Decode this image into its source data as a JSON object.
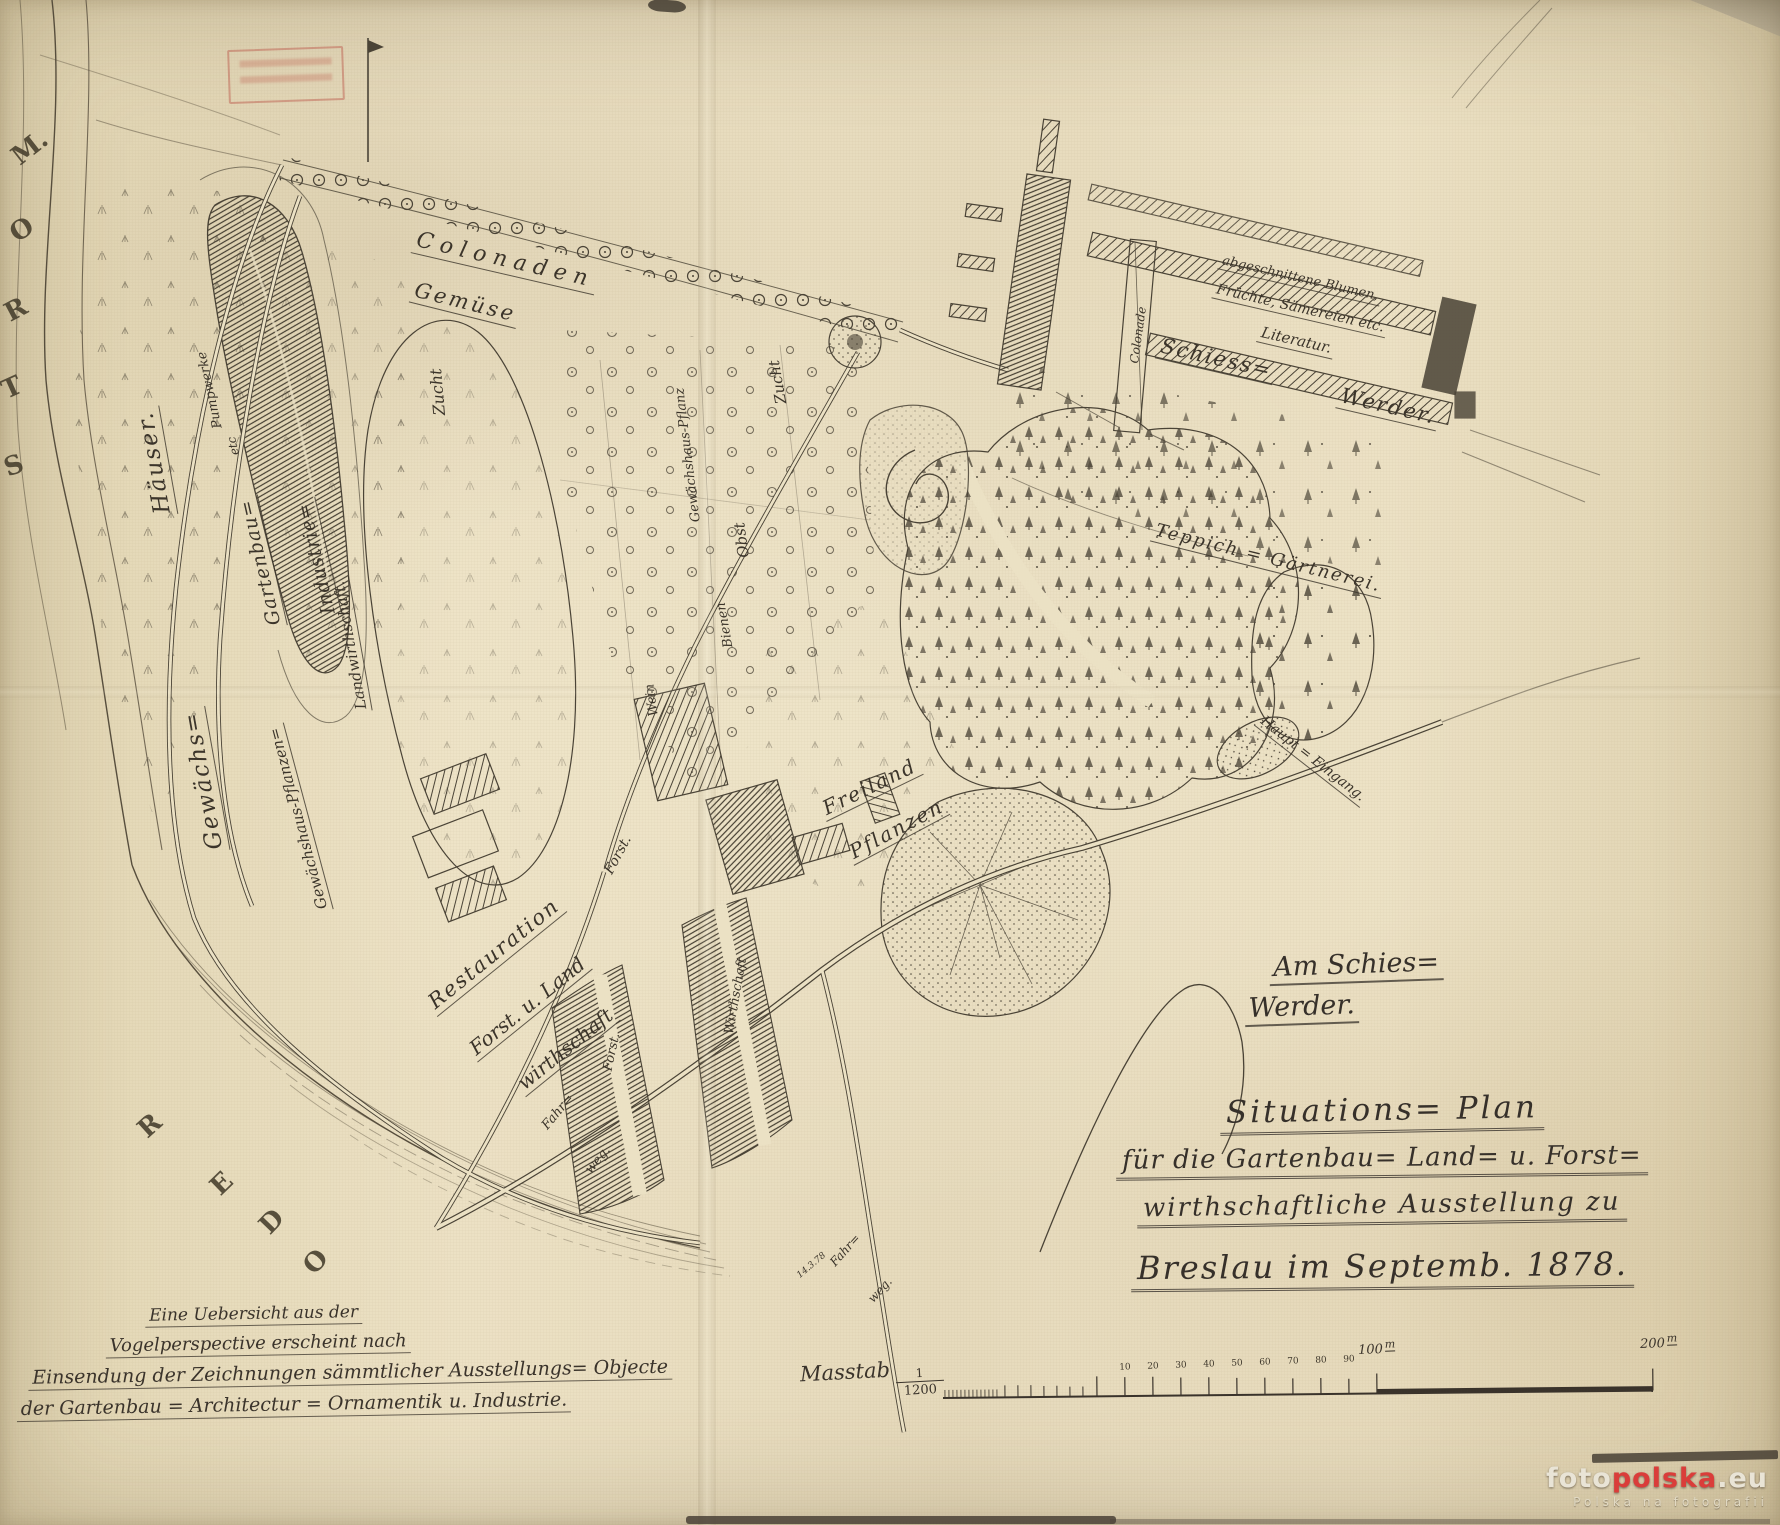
{
  "colors": {
    "ink": "#4a4336",
    "label_ink": "#3b342a",
    "paper": "#ebe1c4",
    "stamp_red": "#bb5446",
    "watermark_red": "#da3d3a"
  },
  "title_block": {
    "line1": "Situations= Plan",
    "line2": "für die Gartenbau= Land= u. Forst=",
    "line3": "wirthschaftliche Ausstellung zu",
    "line4": "Breslau im Septemb. 1878."
  },
  "area_note": {
    "line1": "Am Schies=",
    "line2": "Werder."
  },
  "note_block": {
    "line1": "Eine Uebersicht aus der",
    "line2": "Vogelperspective erscheint nach",
    "line3": "Einsendung der Zeichnungen sämmtlicher Ausstellungs= Objecte",
    "line4": "der Gartenbau = Architectur = Ornamentik u. Industrie."
  },
  "scale_bar": {
    "label": "Masstab",
    "fraction_numerator": "1",
    "fraction_denominator": "1200",
    "label_100": "100",
    "label_200": "200",
    "unit": "m"
  },
  "watermark": {
    "foto": "foto",
    "polska": "polska",
    "eu": ".eu",
    "tagline": "Polska na fotografii"
  },
  "map_labels": [
    {
      "t": "M.",
      "x": 30,
      "y": 148,
      "r": -38,
      "s": 26,
      "c": "riv"
    },
    {
      "t": "O",
      "x": 22,
      "y": 230,
      "r": -32,
      "s": 26,
      "c": "riv"
    },
    {
      "t": "R",
      "x": 16,
      "y": 310,
      "r": -28,
      "s": 26,
      "c": "riv"
    },
    {
      "t": "T",
      "x": 12,
      "y": 388,
      "r": -24,
      "s": 26,
      "c": "riv"
    },
    {
      "t": "S",
      "x": 14,
      "y": 466,
      "r": -20,
      "s": 26,
      "c": "riv"
    },
    {
      "t": "R",
      "x": 150,
      "y": 1126,
      "r": -42,
      "s": 26,
      "c": "riv"
    },
    {
      "t": "E",
      "x": 222,
      "y": 1184,
      "r": -44,
      "s": 26,
      "c": "riv"
    },
    {
      "t": "D",
      "x": 272,
      "y": 1222,
      "r": -46,
      "s": 26,
      "c": "riv"
    },
    {
      "t": "O",
      "x": 316,
      "y": 1262,
      "r": -48,
      "s": 26,
      "c": "riv"
    },
    {
      "t": "Gewächs=",
      "x": 205,
      "y": 780,
      "r": -100,
      "s": 23,
      "c": "u",
      "ls": 2
    },
    {
      "t": "Häuser.",
      "x": 156,
      "y": 462,
      "r": -100,
      "s": 23,
      "c": "u",
      "ls": 2
    },
    {
      "t": "Pumpwerke",
      "x": 210,
      "y": 390,
      "r": -102,
      "s": 13
    },
    {
      "t": "etc",
      "x": 233,
      "y": 446,
      "r": -102,
      "s": 12
    },
    {
      "t": "Gartenbau=",
      "x": 262,
      "y": 562,
      "r": -103,
      "s": 19,
      "c": "u",
      "ls": 1
    },
    {
      "t": "Industrie=",
      "x": 318,
      "y": 558,
      "r": -103,
      "s": 19,
      "c": "u",
      "ls": 1
    },
    {
      "t": "Gewächshaus-Pflanzen=",
      "x": 300,
      "y": 818,
      "r": -105,
      "s": 15,
      "c": "u"
    },
    {
      "t": "Landwirthschaft.",
      "x": 352,
      "y": 645,
      "r": -100,
      "s": 15,
      "c": "u"
    },
    {
      "t": "Colonaden",
      "x": 505,
      "y": 262,
      "r": 13,
      "s": 22,
      "c": "u",
      "ls": 7
    },
    {
      "t": "Gemüse",
      "x": 465,
      "y": 304,
      "r": 14,
      "s": 21,
      "c": "u",
      "ls": 3
    },
    {
      "t": "Zucht",
      "x": 438,
      "y": 392,
      "r": -95,
      "s": 16
    },
    {
      "t": "Gewächshaus-Pflanz",
      "x": 688,
      "y": 455,
      "r": -97,
      "s": 13
    },
    {
      "t": "Zucht",
      "x": 778,
      "y": 382,
      "r": -100,
      "s": 15
    },
    {
      "t": "Obst",
      "x": 742,
      "y": 540,
      "r": -98,
      "s": 15
    },
    {
      "t": "Bienen",
      "x": 725,
      "y": 625,
      "r": -100,
      "s": 13
    },
    {
      "t": "Wein",
      "x": 652,
      "y": 700,
      "r": -98,
      "s": 13
    },
    {
      "t": "Freiland",
      "x": 870,
      "y": 788,
      "r": -26,
      "s": 20,
      "c": "u",
      "ls": 2
    },
    {
      "t": "Pflanzen",
      "x": 897,
      "y": 830,
      "r": -28,
      "s": 20,
      "c": "u",
      "ls": 2
    },
    {
      "t": "Restauration",
      "x": 495,
      "y": 955,
      "r": -39,
      "s": 21,
      "c": "u",
      "ls": 2
    },
    {
      "t": "Forst. u. Land",
      "x": 528,
      "y": 1007,
      "r": -39,
      "s": 20,
      "c": "u"
    },
    {
      "t": "wirthschaft",
      "x": 566,
      "y": 1050,
      "r": -39,
      "s": 20,
      "c": "u"
    },
    {
      "t": "Forst.",
      "x": 618,
      "y": 855,
      "r": -62,
      "s": 14
    },
    {
      "t": "Forst.",
      "x": 612,
      "y": 1052,
      "r": -78,
      "s": 13
    },
    {
      "t": "Wirthschaft",
      "x": 736,
      "y": 996,
      "r": -80,
      "s": 13
    },
    {
      "t": "Fahr=",
      "x": 558,
      "y": 1112,
      "r": -50,
      "s": 13
    },
    {
      "t": "weg.",
      "x": 598,
      "y": 1160,
      "r": -50,
      "s": 13
    },
    {
      "t": "Fahr=",
      "x": 845,
      "y": 1250,
      "r": -48,
      "s": 12
    },
    {
      "t": "weg.",
      "x": 880,
      "y": 1290,
      "r": -48,
      "s": 12
    },
    {
      "t": "14.3.78",
      "x": 812,
      "y": 1266,
      "r": -40,
      "s": 9
    },
    {
      "t": "Colonade",
      "x": 1138,
      "y": 335,
      "r": -82,
      "s": 12
    },
    {
      "t": "abgeschnittene Blumen,",
      "x": 1300,
      "y": 280,
      "r": 13,
      "s": 13,
      "c": "u"
    },
    {
      "t": "Früchte, Sämereien etc.",
      "x": 1300,
      "y": 310,
      "r": 13,
      "s": 14,
      "c": "u"
    },
    {
      "t": "Literatur.",
      "x": 1296,
      "y": 342,
      "r": 13,
      "s": 15,
      "c": "u"
    },
    {
      "t": "Schiess=",
      "x": 1216,
      "y": 360,
      "r": 13,
      "s": 21,
      "c": "u",
      "ls": 2
    },
    {
      "t": "Werder.",
      "x": 1388,
      "y": 408,
      "r": 13,
      "s": 21,
      "c": "u",
      "ls": 2
    },
    {
      "t": "Teppich = Gärtnerei.",
      "x": 1268,
      "y": 560,
      "r": 14,
      "s": 18,
      "c": "u",
      "ls": 2
    },
    {
      "t": "Haupt = Eingang.",
      "x": 1312,
      "y": 760,
      "r": 38,
      "s": 14,
      "c": "u"
    },
    {
      "t": "10",
      "x": 1125,
      "y": 1368,
      "r": -2,
      "s": 9,
      "c": "tick"
    },
    {
      "t": "20",
      "x": 1153,
      "y": 1367,
      "r": -2,
      "s": 9,
      "c": "tick"
    },
    {
      "t": "30",
      "x": 1181,
      "y": 1366,
      "r": -2,
      "s": 9,
      "c": "tick"
    },
    {
      "t": "40",
      "x": 1209,
      "y": 1365,
      "r": -2,
      "s": 9,
      "c": "tick"
    },
    {
      "t": "50",
      "x": 1237,
      "y": 1364,
      "r": -2,
      "s": 9,
      "c": "tick"
    },
    {
      "t": "60",
      "x": 1265,
      "y": 1363,
      "r": -2,
      "s": 9,
      "c": "tick"
    },
    {
      "t": "70",
      "x": 1293,
      "y": 1362,
      "r": -2,
      "s": 9,
      "c": "tick"
    },
    {
      "t": "80",
      "x": 1321,
      "y": 1361,
      "r": -2,
      "s": 9,
      "c": "tick"
    },
    {
      "t": "90",
      "x": 1349,
      "y": 1360,
      "r": -2,
      "s": 9,
      "c": "tick"
    }
  ]
}
